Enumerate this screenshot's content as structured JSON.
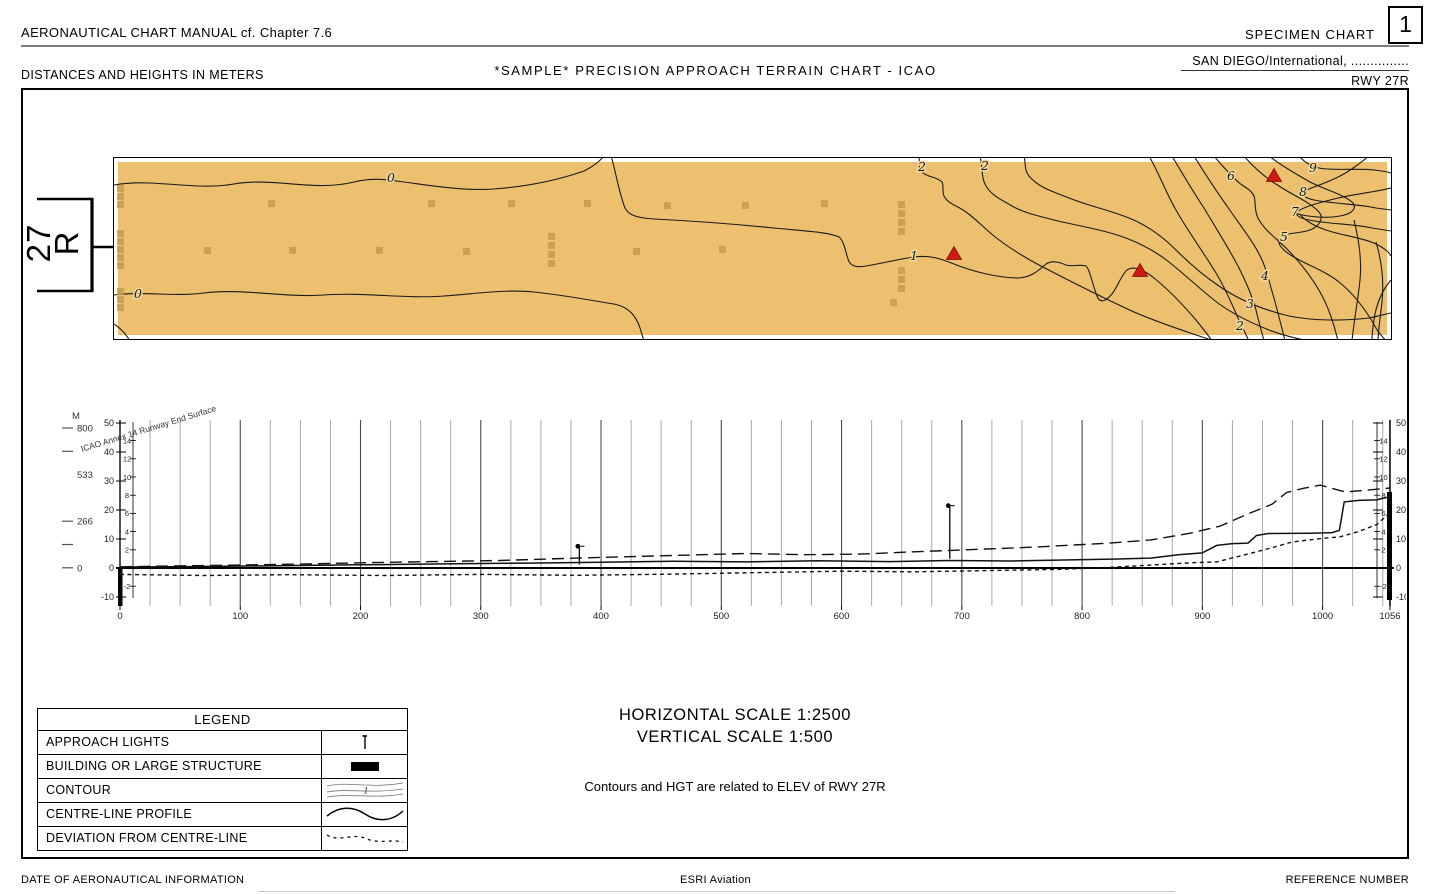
{
  "header": {
    "manual_ref": "AERONAUTICAL CHART MANUAL cf. Chapter 7.6",
    "specimen_label": "SPECIMEN CHART",
    "sheet_number": "1",
    "units_note": "DISTANCES AND HEIGHTS IN METERS",
    "title": "*SAMPLE* PRECISION APPROACH TERRAIN CHART - ICAO",
    "location": "SAN DIEGO/International, ...............",
    "runway": "RWY 27R"
  },
  "map": {
    "runway_designator_line1": "27",
    "runway_designator_line2": "R",
    "terrain_color": "#ecc06e",
    "building_color": "#c79a4a",
    "triangle_color": "#cf1a12",
    "contour_labels": [
      {
        "t": "0",
        "x": 277,
        "y": 19
      },
      {
        "t": "0",
        "x": 24,
        "y": 135
      },
      {
        "t": "1",
        "x": 800,
        "y": 97
      },
      {
        "t": "2",
        "x": 808,
        "y": 8
      },
      {
        "t": "2",
        "x": 871,
        "y": 7
      },
      {
        "t": "6",
        "x": 1117,
        "y": 17
      },
      {
        "t": "9",
        "x": 1199,
        "y": 9
      },
      {
        "t": "8",
        "x": 1189,
        "y": 33
      },
      {
        "t": "7",
        "x": 1181,
        "y": 53
      },
      {
        "t": "5",
        "x": 1170,
        "y": 78
      },
      {
        "t": "4",
        "x": 1151,
        "y": 117
      },
      {
        "t": "3",
        "x": 1136,
        "y": 145
      },
      {
        "t": "2",
        "x": 1126,
        "y": 167
      }
    ],
    "obstacle_triangles": [
      {
        "x": 840,
        "y": 96
      },
      {
        "x": 1026,
        "y": 113
      },
      {
        "x": 1160,
        "y": 18
      }
    ],
    "buildings": [
      [
        154,
        42
      ],
      [
        314,
        42
      ],
      [
        394,
        42
      ],
      [
        470,
        42
      ],
      [
        550,
        44
      ],
      [
        628,
        44
      ],
      [
        707,
        42
      ],
      [
        90,
        89
      ],
      [
        175,
        89
      ],
      [
        262,
        89
      ],
      [
        349,
        90
      ],
      [
        519,
        90
      ],
      [
        605,
        88
      ],
      [
        434,
        75
      ],
      [
        434,
        84
      ],
      [
        434,
        93
      ],
      [
        434,
        102
      ],
      [
        3,
        27
      ],
      [
        3,
        35
      ],
      [
        3,
        43
      ],
      [
        3,
        72
      ],
      [
        3,
        80
      ],
      [
        3,
        88
      ],
      [
        3,
        96
      ],
      [
        3,
        104
      ],
      [
        3,
        130
      ],
      [
        3,
        138
      ],
      [
        3,
        146
      ],
      [
        784,
        43
      ],
      [
        784,
        52
      ],
      [
        784,
        61
      ],
      [
        784,
        70
      ],
      [
        784,
        109
      ],
      [
        784,
        118
      ],
      [
        784,
        127
      ],
      [
        776,
        141
      ]
    ]
  },
  "profile": {
    "unit_label": "M",
    "outer_scale": [
      {
        "v": "800",
        "dash": true
      },
      {
        "v": "",
        "dash": true
      },
      {
        "v": "533",
        "dash": false
      },
      {
        "v": "",
        "dash": false
      },
      {
        "v": "266",
        "dash": true
      },
      {
        "v": "",
        "dash": true
      },
      {
        "v": "0",
        "dash": true
      }
    ],
    "meter_ticks": [
      50,
      40,
      30,
      20,
      10,
      0,
      -10
    ],
    "feet_ticks": [
      14,
      12,
      10,
      8,
      6,
      4,
      2,
      -2
    ],
    "x_ticks": [
      0,
      100,
      200,
      300,
      400,
      500,
      600,
      700,
      800,
      900,
      1000,
      1056
    ],
    "surface_label": "ICAO Annex 14 Runway End Surface"
  },
  "chart_data": {
    "type": "line",
    "title": "Precision approach terrain profile RWY 27R",
    "xlabel": "Distance from runway end (m)",
    "ylabel": "Height (m)",
    "xlim": [
      0,
      1056
    ],
    "ylim": [
      -10,
      50
    ],
    "grid": "vertical, every 25 m (bold every 100 m)",
    "series": [
      {
        "name": "ICAO Annex 14 Runway End Surface",
        "style": "long-dash",
        "points": [
          [
            0,
            0.4
          ],
          [
            60,
            0.8
          ],
          [
            130,
            1.2
          ],
          [
            200,
            1.8
          ],
          [
            260,
            2.2
          ],
          [
            316,
            2.6
          ],
          [
            380,
            3.4
          ],
          [
            450,
            4.2
          ],
          [
            520,
            5.0
          ],
          [
            570,
            4.6
          ],
          [
            615,
            4.8
          ],
          [
            660,
            5.6
          ],
          [
            700,
            6.2
          ],
          [
            760,
            7.2
          ],
          [
            823,
            8.6
          ],
          [
            857,
            9.7
          ],
          [
            890,
            12.0
          ],
          [
            915,
            14.5
          ],
          [
            940,
            19.0
          ],
          [
            958,
            22.0
          ],
          [
            970,
            26.0
          ],
          [
            984,
            27.5
          ],
          [
            998,
            28.6
          ],
          [
            1010,
            27.2
          ],
          [
            1019,
            26.2
          ],
          [
            1035,
            26.8
          ],
          [
            1056,
            27.6
          ]
        ]
      },
      {
        "name": "CENTRE-LINE PROFILE",
        "style": "solid",
        "points": [
          [
            0,
            0.3
          ],
          [
            60,
            0.5
          ],
          [
            130,
            0.8
          ],
          [
            200,
            1.1
          ],
          [
            270,
            1.4
          ],
          [
            340,
            1.7
          ],
          [
            400,
            2.0
          ],
          [
            460,
            2.3
          ],
          [
            520,
            2.1
          ],
          [
            580,
            2.5
          ],
          [
            640,
            2.2
          ],
          [
            690,
            2.6
          ],
          [
            740,
            2.4
          ],
          [
            790,
            2.8
          ],
          [
            830,
            3.1
          ],
          [
            857,
            3.4
          ],
          [
            880,
            4.6
          ],
          [
            900,
            5.2
          ],
          [
            912,
            7.8
          ],
          [
            925,
            8.4
          ],
          [
            938,
            8.6
          ],
          [
            945,
            11.2
          ],
          [
            955,
            11.9
          ],
          [
            990,
            12.0
          ],
          [
            1008,
            12.2
          ],
          [
            1014,
            13.0
          ],
          [
            1018,
            22.8
          ],
          [
            1030,
            23.3
          ],
          [
            1045,
            23.5
          ],
          [
            1050,
            24.0
          ],
          [
            1056,
            24.6
          ]
        ]
      },
      {
        "name": "DEVIATION FROM CENTRE-LINE",
        "style": "short-dash",
        "points": [
          [
            0,
            -2.2
          ],
          [
            70,
            -2.6
          ],
          [
            140,
            -2.3
          ],
          [
            220,
            -2.6
          ],
          [
            300,
            -2.2
          ],
          [
            380,
            -2.5
          ],
          [
            460,
            -2.1
          ],
          [
            530,
            -1.6
          ],
          [
            600,
            -1.1
          ],
          [
            660,
            -1.3
          ],
          [
            720,
            -0.9
          ],
          [
            780,
            -0.5
          ],
          [
            823,
            0.2
          ],
          [
            857,
            1.0
          ],
          [
            890,
            1.8
          ],
          [
            912,
            2.1
          ],
          [
            935,
            4.5
          ],
          [
            958,
            7.0
          ],
          [
            975,
            9.0
          ],
          [
            1000,
            10.2
          ],
          [
            1015,
            10.8
          ],
          [
            1030,
            12.6
          ],
          [
            1045,
            15.0
          ],
          [
            1056,
            19.0
          ]
        ]
      }
    ],
    "approach_lights": [
      {
        "x": 382,
        "base": 1.2,
        "top": 7.5
      },
      {
        "x": 690,
        "base": 3.2,
        "top": 21.5
      }
    ]
  },
  "legend": {
    "title": "LEGEND",
    "rows": [
      {
        "label": "APPROACH LIGHTS",
        "symbol": "approach-lights"
      },
      {
        "label": "BUILDING OR LARGE STRUCTURE",
        "symbol": "building"
      },
      {
        "label": "CONTOUR",
        "symbol": "contour"
      },
      {
        "label": "CENTRE-LINE PROFILE",
        "symbol": "centreline"
      },
      {
        "label": "DEVIATION FROM CENTRE-LINE",
        "symbol": "deviation"
      }
    ]
  },
  "notes": {
    "horizontal_scale": "HORIZONTAL SCALE 1:2500",
    "vertical_scale": "VERTICAL SCALE 1:500",
    "contour_note": "Contours and HGT are related to ELEV of RWY 27R"
  },
  "footer": {
    "left": "DATE OF AERONAUTICAL INFORMATION",
    "center": "ESRI Aviation",
    "right": "REFERENCE NUMBER"
  }
}
